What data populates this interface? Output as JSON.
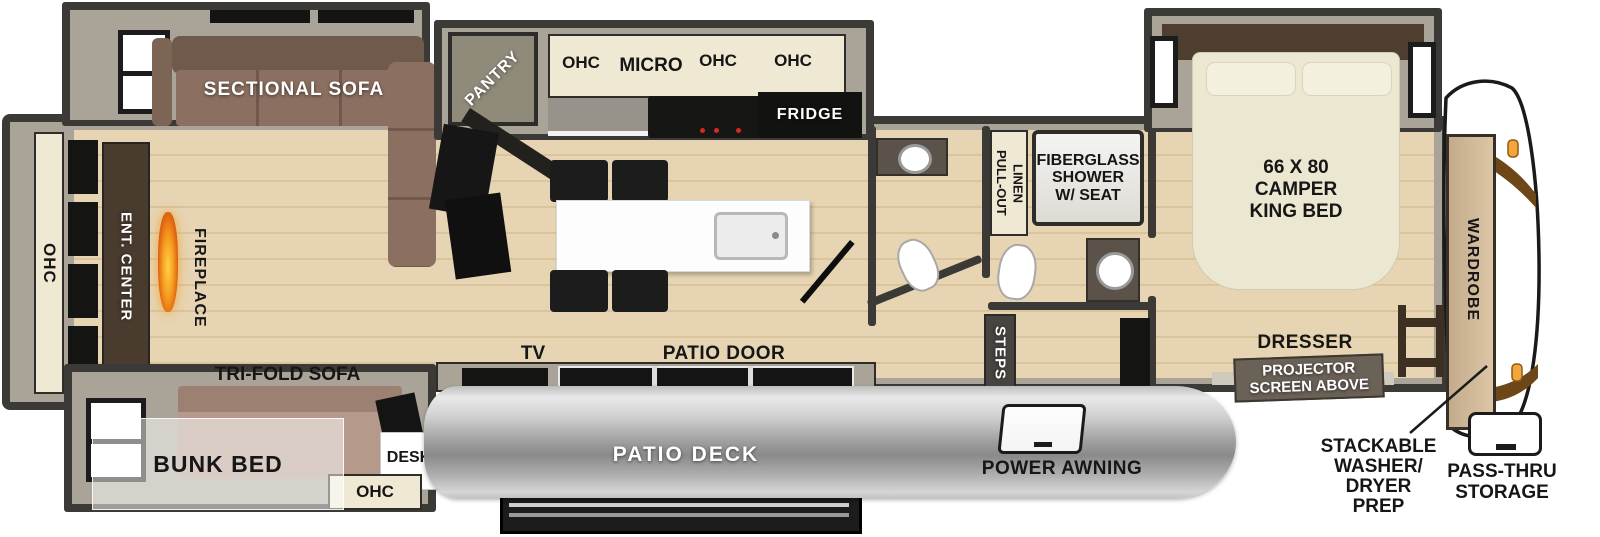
{
  "labels": {
    "sectional_sofa": "SECTIONAL SOFA",
    "pantry": "PANTRY",
    "ohc_a": "OHC",
    "micro": "MICRO",
    "ohc_b": "OHC",
    "ohc_c": "OHC",
    "fridge": "FRIDGE",
    "pull_out_linen": "PULL-OUT\nLINEN",
    "shower": "FIBERGLASS\nSHOWER\nW/ SEAT",
    "king_bed": "66 X 80\nCAMPER\nKING BED",
    "wardrobe": "WARDROBE",
    "ohc_rear": "OHC",
    "ent_center": "ENT. CENTER",
    "fireplace": "FIREPLACE",
    "tri_fold_sofa": "TRI-FOLD SOFA",
    "bunk_bed": "BUNK BED",
    "desk": "DESK",
    "ohc_desk": "OHC",
    "tv": "TV",
    "patio_door": "PATIO DOOR",
    "patio_deck": "PATIO DECK",
    "power_awning": "POWER AWNING",
    "steps": "STEPS",
    "dresser": "DRESSER",
    "projector": "PROJECTOR\nSCREEN ABOVE",
    "washer_prep": "STACKABLE\nWASHER/\nDRYER\nPREP",
    "pass_thru": "PASS-THRU\nSTORAGE"
  },
  "colors": {
    "wall": "#3b3a36",
    "trim": "#a9a497",
    "floor": "#e6d4b2",
    "cabinet": "#efe8d3",
    "sofa": "#8b7061",
    "bed": "#ebe7d1",
    "awning": "#b5b5b5",
    "flame": "#f59b1e",
    "clearance_light": "#f5a63a",
    "front_cap": "#ffffff"
  }
}
